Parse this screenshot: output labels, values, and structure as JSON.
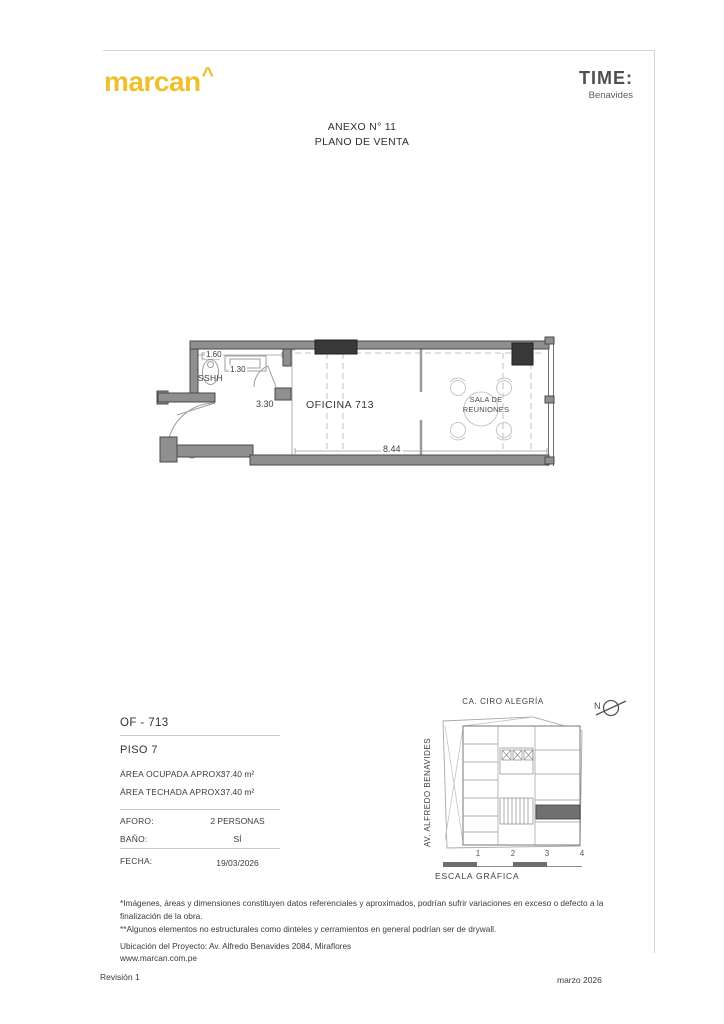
{
  "header": {
    "logo": "marcan",
    "logo_caret": "^",
    "brand": "TIME:",
    "brand_sub": "Benavides",
    "anexo": "ANEXO N° 11",
    "titulo": "PLANO DE VENTA"
  },
  "floorplan": {
    "dim_160": "1.60",
    "dim_130": "1.30",
    "sshh_label": "SSHH",
    "dim_330": "3.30",
    "office_label": "OFICINA 713",
    "meeting_line1": "SALA DE",
    "meeting_line2": "REUNIONES",
    "dim_844": "8.44"
  },
  "info": {
    "unit": "OF - 713",
    "floor": "PISO 7",
    "rows": [
      {
        "label": "ÁREA OCUPADA APROX:",
        "value": "37.40 m²"
      },
      {
        "label": "ÁREA TECHADA APROX:",
        "value": "37.40 m²"
      }
    ],
    "aforo_label": "AFORO:",
    "aforo_value": "2 PERSONAS",
    "bano_label": "BAÑO:",
    "bano_value": "SÍ",
    "fecha_label": "FECHA:",
    "fecha_value": "19/03/2026"
  },
  "sitemap": {
    "street_top": "CA. CIRO ALEGRÍA",
    "street_left": "AV. ALFREDO BENAVIDES",
    "north": "N",
    "scale_ticks": [
      "1",
      "2",
      "3",
      "4"
    ],
    "scale_label": "ESCALA GRÁFICA"
  },
  "footer": {
    "note1": "*Imágenes, áreas y dimensiones constituyen datos referenciales y aproximados, podrían sufrir variaciones en exceso o defecto a la finalización de la obra.",
    "note2": "**Algunos elementos no estructurales como dinteles y cerramientos en general podrían ser de drywall.",
    "ubicacion": "Ubicación del Proyecto: Av. Alfredo Benavides 2084, Miraflores",
    "web": "www.marcan.com.pe",
    "revision": "Revisión 1",
    "fecha_doc": "marzo 2026"
  },
  "colors": {
    "accent": "#EEC02B",
    "wall": "#8F8F8F",
    "column": "#383838",
    "rule": "#D6D6D6"
  }
}
